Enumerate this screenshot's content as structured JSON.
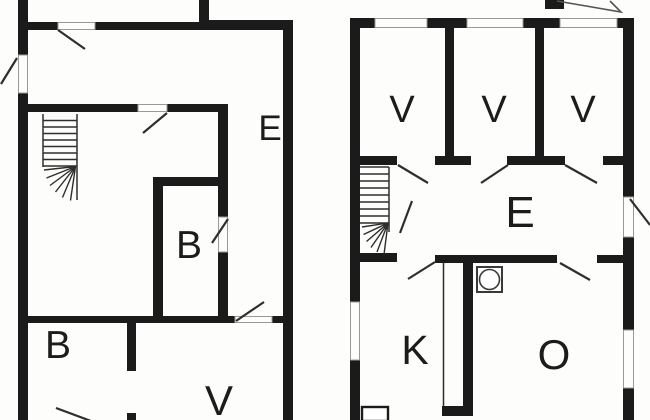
{
  "document": {
    "kind": "architectural floor plan drawing",
    "plan_count": 2
  },
  "colors": {
    "background": "#fdfdfb",
    "wall": "#1b1b1b",
    "thin_line": "#2e2e2e",
    "jamb_outline": "#999999",
    "symbol_outline": "#3a3a3a"
  },
  "plans": {
    "left": {
      "name": "left-floor-plan",
      "rooms": {
        "e": "E",
        "b_inner": "B",
        "b_lower": "B",
        "v_lower": "V"
      }
    },
    "right": {
      "name": "right-floor-plan",
      "rooms": {
        "v1": "V",
        "v2": "V",
        "v3": "V",
        "e": "E",
        "k": "K",
        "o": "O"
      }
    }
  },
  "symbols": {
    "stairs_left": "staircase-with-winders",
    "stairs_right": "staircase-with-winders",
    "stove": "stove-circle-in-square",
    "entrance_arrow": "arrowhead-pointing-down-right",
    "label_fragment": "cut-off-letter-at-top-edge"
  }
}
